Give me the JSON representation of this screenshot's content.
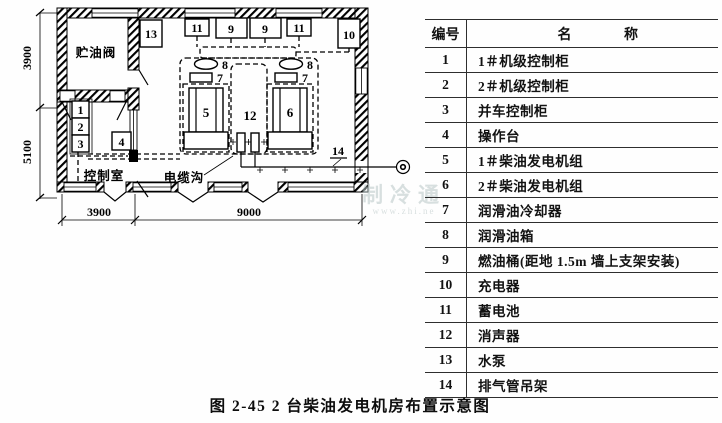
{
  "figure": {
    "caption": "图 2-45  2 台柴油发电机房布置示意图"
  },
  "table": {
    "header": {
      "id": "编号",
      "name_a": "名",
      "name_b": "称"
    },
    "rows": [
      {
        "id": "1",
        "name": "1＃机级控制柜"
      },
      {
        "id": "2",
        "name": "2＃机级控制柜"
      },
      {
        "id": "3",
        "name": "并车控制柜"
      },
      {
        "id": "4",
        "name": "操作台"
      },
      {
        "id": "5",
        "name": "1＃柴油发电机组"
      },
      {
        "id": "6",
        "name": "2＃柴油发电机组"
      },
      {
        "id": "7",
        "name": "润滑油冷却器"
      },
      {
        "id": "8",
        "name": "润滑油箱"
      },
      {
        "id": "9",
        "name": "燃油桶(距地 1.5m 墙上支架安装)"
      },
      {
        "id": "10",
        "name": "充电器"
      },
      {
        "id": "11",
        "name": "蓄电池"
      },
      {
        "id": "12",
        "name": "消声器"
      },
      {
        "id": "13",
        "name": "水泵"
      },
      {
        "id": "14",
        "name": "排气管吊架"
      }
    ]
  },
  "plan": {
    "rooms": {
      "oil": "贮油阀",
      "control": "控制室",
      "trench": "电缆沟"
    },
    "dims": {
      "left_top": "3900",
      "left_bottom": "5100",
      "bottom_left": "3900",
      "bottom_right": "9000"
    },
    "callouts": {
      "c1": "1",
      "c2": "2",
      "c3": "3",
      "c4": "4",
      "c5": "5",
      "c6": "6",
      "c7": "7",
      "c8": "8",
      "c9": "9",
      "c10": "10",
      "c11": "11",
      "c12": "12",
      "c13": "13",
      "c14": "14"
    }
  },
  "watermark": {
    "line1": "制冷通",
    "line2": "www.zhi.ne"
  }
}
